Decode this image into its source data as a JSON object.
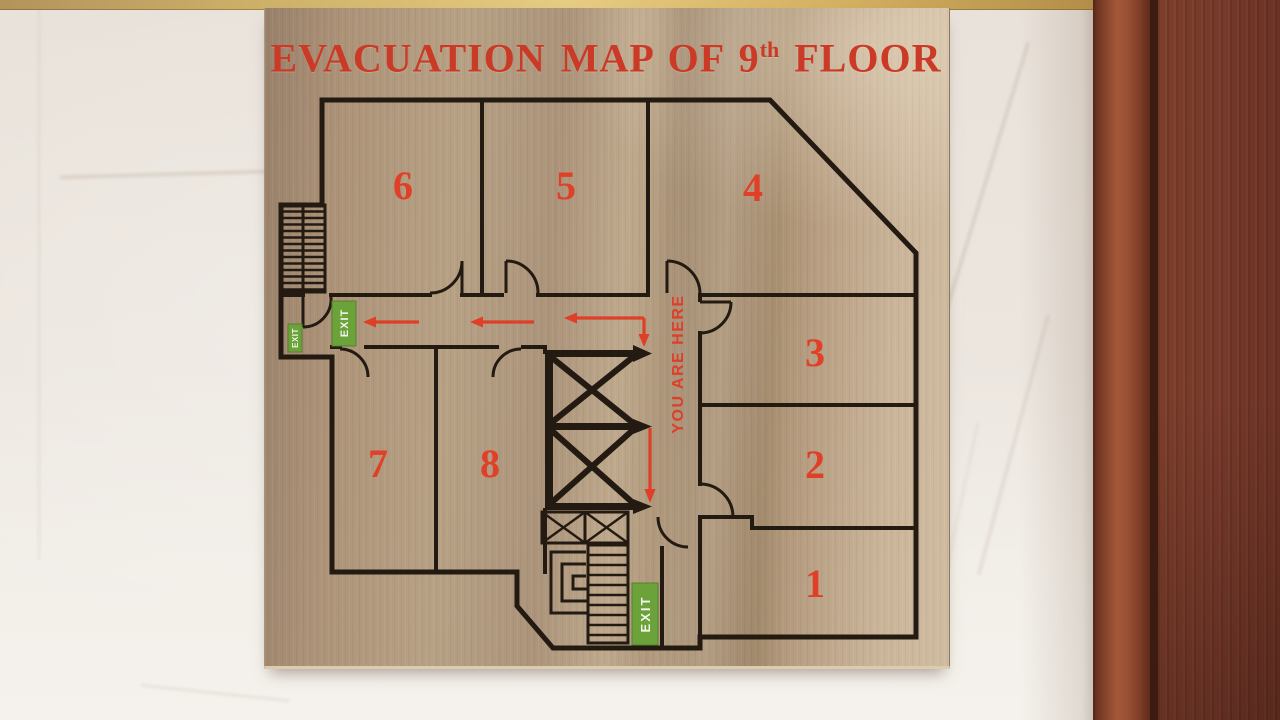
{
  "sign": {
    "title": {
      "prefix": "EVACUATION MAP OF 9",
      "superscript": "th",
      "suffix": " FLOOR"
    },
    "rooms": [
      "1",
      "2",
      "3",
      "4",
      "5",
      "6",
      "7",
      "8"
    ],
    "exit_signs": [
      {
        "id": "exit-left-small",
        "label": "EXIT"
      },
      {
        "id": "exit-left-large",
        "label": "EXIT"
      },
      {
        "id": "exit-bottom",
        "label": "EXIT"
      }
    ],
    "you_are_here": "YOU ARE HERE",
    "colors": {
      "title_red": "#cb3a26",
      "route_red": "#df3e28",
      "exit_green": "#6ba23a",
      "plan_line": "#231a12",
      "plate_steel": "#b7a185",
      "gold_trim": "#d9bd72",
      "marble_wall": "#eee8e1",
      "wood_frame": "#76392a"
    }
  }
}
